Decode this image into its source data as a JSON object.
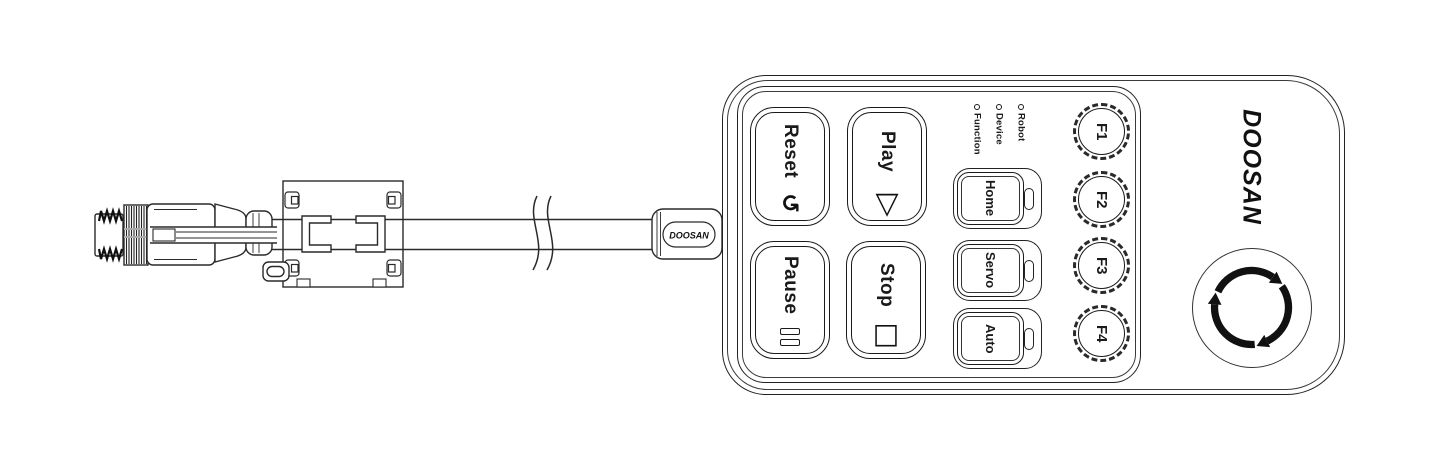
{
  "pendant": {
    "brand_logo": "DOOSAN",
    "main_keys": [
      {
        "label": "Reset",
        "icon": "↺",
        "icon_name": "reset-arrow-icon"
      },
      {
        "label": "Play",
        "icon": "▽",
        "icon_name": "play-triangle-icon"
      },
      {
        "label": "Pause",
        "icon": "‖ (two bars)",
        "icon_name": "pause-bars-icon"
      },
      {
        "label": "Stop",
        "icon": "□",
        "icon_name": "stop-square-icon"
      }
    ],
    "status_leds": [
      {
        "label": "Robot"
      },
      {
        "label": "Device"
      },
      {
        "label": "Function"
      }
    ],
    "mode_keys": [
      {
        "label": "Home"
      },
      {
        "label": "Servo"
      },
      {
        "label": "Auto"
      }
    ],
    "function_keys": [
      {
        "label": "F1"
      },
      {
        "label": "F2"
      },
      {
        "label": "F3"
      },
      {
        "label": "F4"
      }
    ],
    "estop": {
      "icon_name": "rotate-to-release-arrows-icon"
    }
  },
  "cable": {
    "label": "DOOSAN",
    "parts": [
      "m12-connector",
      "ferrite-core-clamp",
      "cable-break-mark",
      "strain-relief-boot"
    ]
  },
  "colors": {
    "line": "#1a1a1a",
    "background": "#ffffff"
  }
}
